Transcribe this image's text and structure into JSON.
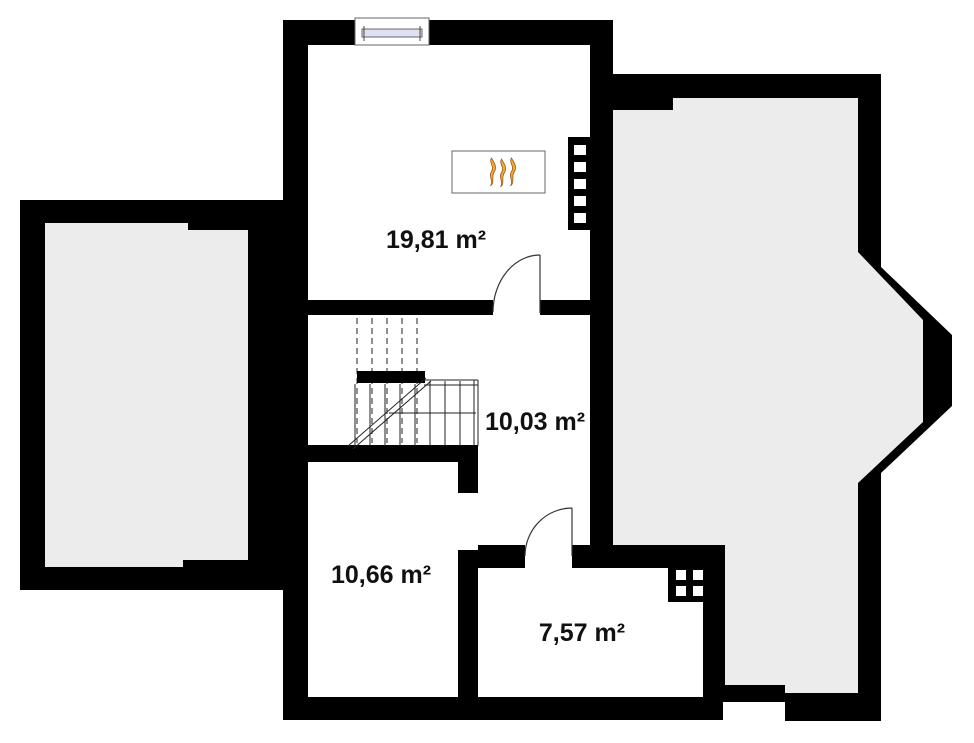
{
  "plan": {
    "type": "floor-plan",
    "units": "m²",
    "background": "#ffffff",
    "rooms": [
      {
        "name": "room-top",
        "area_label": "19,81 m²",
        "area_value": "19,81"
      },
      {
        "name": "room-stair-hall",
        "area_label": "10,03 m²",
        "area_value": "10,03"
      },
      {
        "name": "room-bottom-left",
        "area_label": "10,66 m²",
        "area_value": "10,66"
      },
      {
        "name": "room-bottom-right",
        "area_label": "7,57 m²",
        "area_value": "7,57"
      }
    ],
    "colors": {
      "wall": "#000000",
      "room_fill": "#ffffff",
      "annex_fill": "#ececec",
      "window_glass": "#dde1f2",
      "flame_fill": "#f2a93b",
      "flame_stroke": "#9c5a15",
      "line": "#333333",
      "label_text": "#111111"
    },
    "icons": {
      "fireplace": "fireplace-flames-icon",
      "window": "window-icon",
      "stairs": "staircase-icon",
      "door": "door-swing-icon",
      "radiator": "radiator-icon",
      "flue": "chimney-flue-icon"
    }
  }
}
